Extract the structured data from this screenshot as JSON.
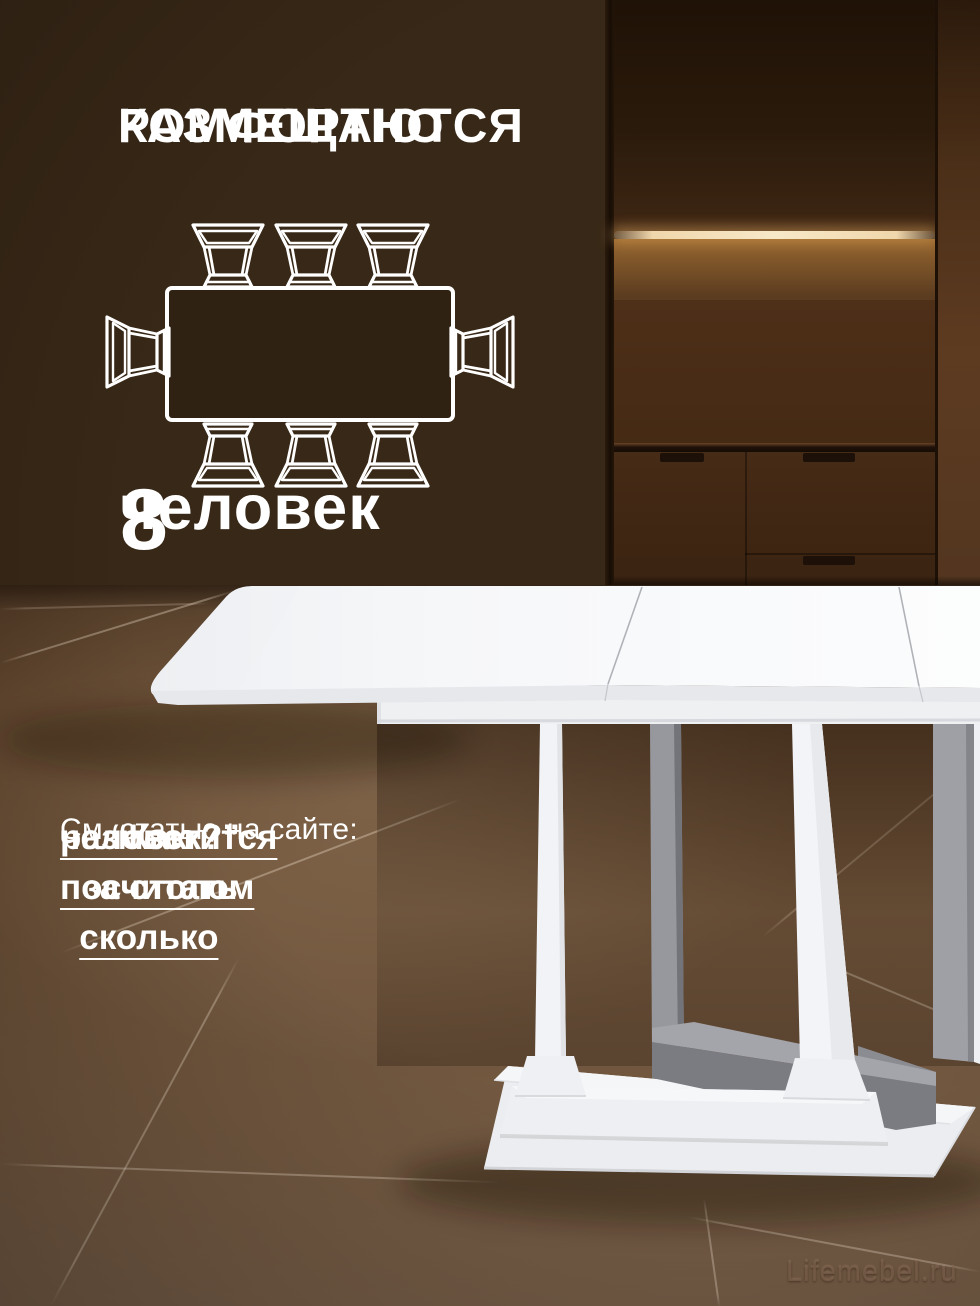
{
  "headline": {
    "line1": "КОМФОРТНО",
    "line2": "РАЗМЕЩАЮТСЯ"
  },
  "capacity": {
    "number": "8",
    "unit": "человек"
  },
  "seating_diagram": {
    "kind": "top-view-table-seating",
    "total_seats": 8,
    "chairs_top": 3,
    "chairs_bottom": 3,
    "chairs_left": 1,
    "chairs_right": 1
  },
  "article_note": {
    "intro": "См. статью на сайте:",
    "link_lines": [
      "“Как посчитать сколько",
      "разместится за столом",
      "человек?”"
    ]
  },
  "watermark": "Lifemebel.ru",
  "colors": {
    "wall_brown": "#3a2817",
    "floor_brown": "#6e5238",
    "under_cabinet_light": "#f2d9ae",
    "table_white": "#f5f6f8",
    "frame_gray": "#9b9ca1",
    "text_white": "#ffffff"
  }
}
